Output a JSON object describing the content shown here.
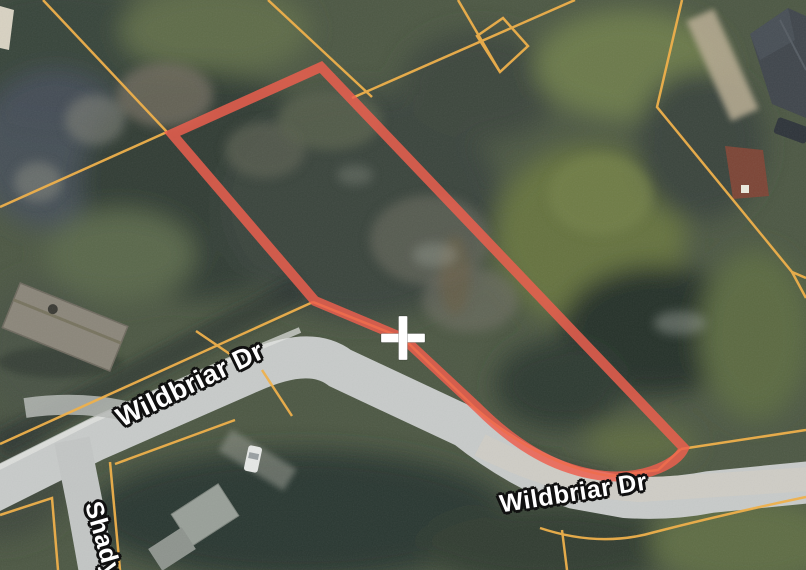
{
  "view": {
    "type": "satellite-map",
    "road_labels": [
      {
        "text": "Wildbriar Dr"
      },
      {
        "text": "Wildbriar Dr"
      },
      {
        "text": "Shady"
      }
    ],
    "marker": {
      "type": "crosshair",
      "symbol": "+",
      "color": "#ffffff"
    },
    "colors": {
      "parcel_highlight": "#ed5f4f",
      "parcel_lines": "#eeb04c",
      "road": "#c8cbca"
    }
  }
}
